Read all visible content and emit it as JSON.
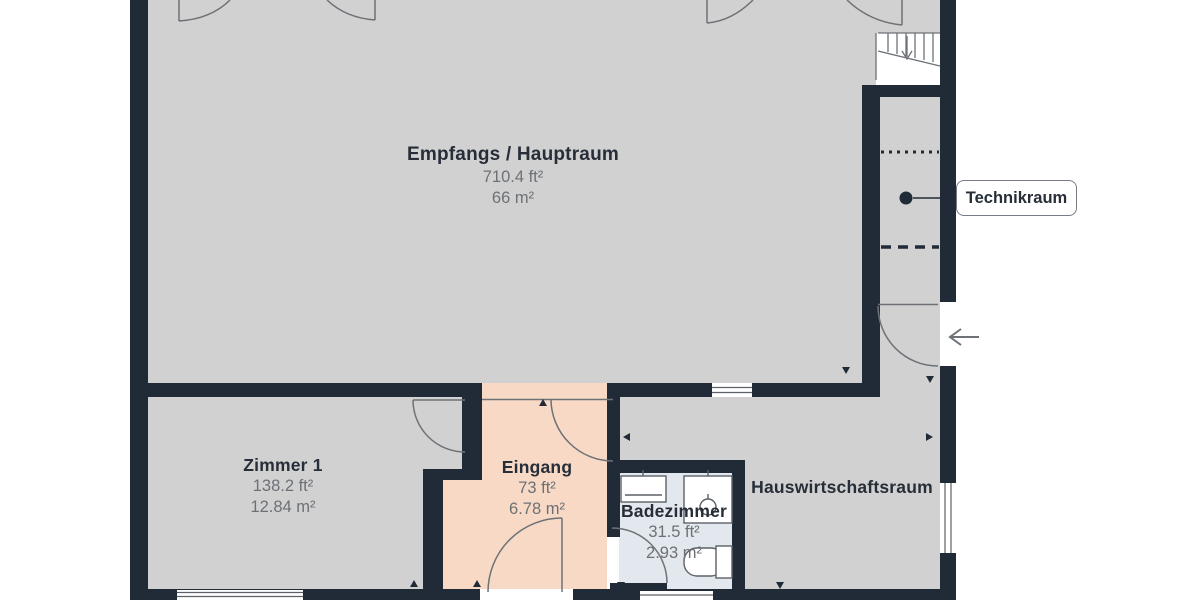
{
  "rooms": {
    "hauptraum": {
      "name": "Empfangs / Hauptraum",
      "area_ft": "710.4 ft²",
      "area_m": "66 m²"
    },
    "zimmer1": {
      "name": "Zimmer 1",
      "area_ft": "138.2 ft²",
      "area_m": "12.84 m²"
    },
    "eingang": {
      "name": "Eingang",
      "area_ft": "73 ft²",
      "area_m": "6.78 m²"
    },
    "badezimmer": {
      "name": "Badezimmer",
      "area_ft": "31.5 ft²",
      "area_m": "2.93 m²"
    },
    "hauswirtschaftsraum": {
      "name": "Hauswirtschaftsraum"
    },
    "technikraum": {
      "name": "Technikraum"
    }
  },
  "colors": {
    "wall": "#212b38",
    "floor": "#d1d1d2",
    "entry_floor": "#f7d9c6",
    "bath_floor": "#e2e8ee",
    "title_text": "#272e38",
    "area_text": "#6d7175",
    "line": "#6e7276"
  }
}
